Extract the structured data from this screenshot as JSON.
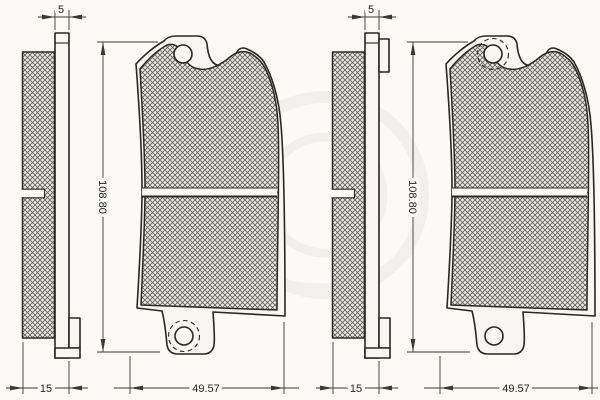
{
  "diagram": {
    "type": "technical-drawing",
    "subject": "disc-brake-pad-set, side profile and front view of two pads",
    "left_pad": {
      "plate_thickness": "5",
      "total_thickness": "15",
      "height": "108.80",
      "width": "49.57"
    },
    "right_pad": {
      "plate_thickness": "5",
      "total_thickness": "15",
      "height": "108.80",
      "width": "49.57"
    }
  },
  "colors": {
    "line": "#2a2722",
    "dim_line": "#3b3831",
    "background": "#fbfaf7",
    "plate_fill": "#f7f6f2",
    "hatch_bg": "#e8e7e3",
    "hatch_line": "#605e57",
    "watermark": "#f1f0ec"
  }
}
